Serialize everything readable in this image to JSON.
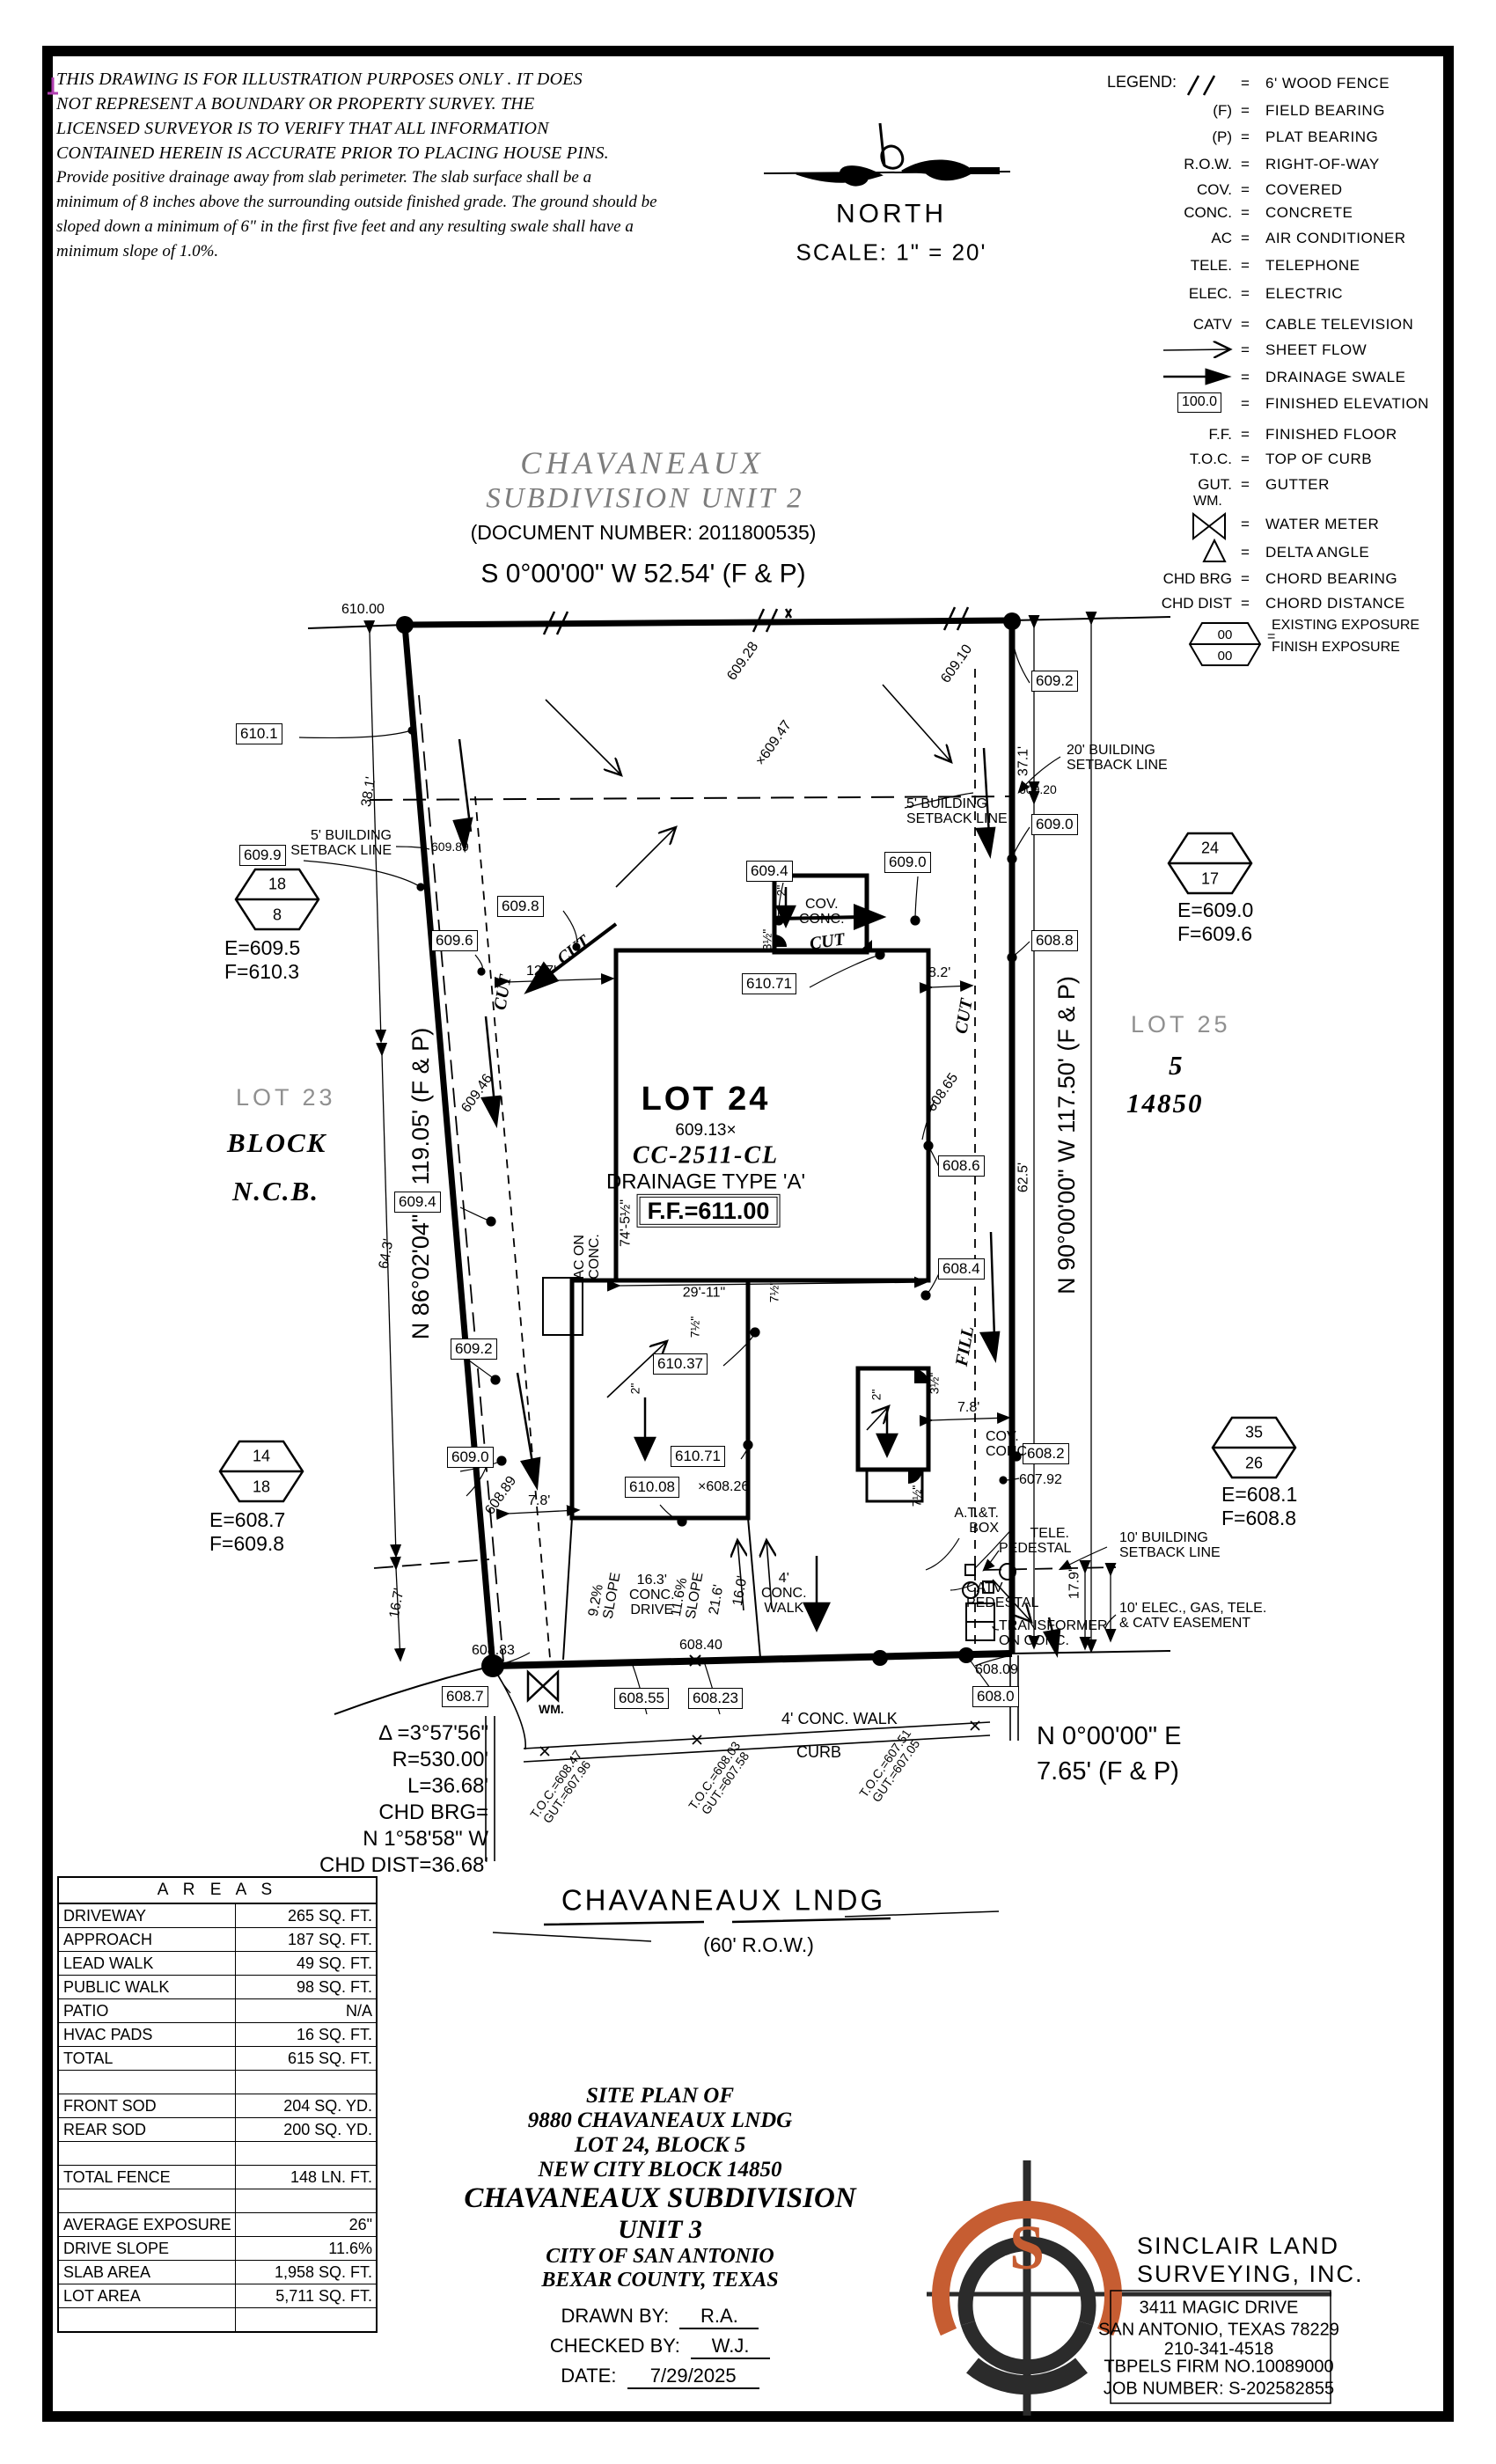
{
  "disclaimer": {
    "l1": "THIS DRAWING IS FOR ILLUSTRATION PURPOSES ONLY . IT DOES",
    "l2": "NOT REPRESENT A BOUNDARY OR PROPERTY SURVEY. THE",
    "l3": "LICENSED SURVEYOR IS TO VERIFY THAT ALL INFORMATION",
    "l4": "CONTAINED HEREIN IS ACCURATE PRIOR TO PLACING HOUSE PINS.",
    "l5": "Provide positive drainage away from slab perimeter. The slab surface shall be a",
    "l6": "minimum of 8 inches above the surrounding outside finished grade. The ground should be",
    "l7": "sloped down a minimum of 6\" in the first five feet and any resulting swale shall have a",
    "l8": "minimum slope of 1.0%."
  },
  "north": {
    "label": "NORTH",
    "scale": "SCALE:  1\" = 20'"
  },
  "legend": {
    "title": "LEGEND:",
    "fence_sym": "//",
    "fence": "6' WOOD FENCE",
    "f_sym": "(F)",
    "f": "FIELD BEARING",
    "p_sym": "(P)",
    "p": "PLAT BEARING",
    "row_sym": "R.O.W.",
    "row": "RIGHT-OF-WAY",
    "cov_sym": "COV.",
    "cov": "COVERED",
    "conc_sym": "CONC.",
    "conc": "CONCRETE",
    "ac_sym": "AC",
    "ac": "AIR CONDITIONER",
    "tele_sym": "TELE.",
    "tele": "TELEPHONE",
    "elec_sym": "ELEC.",
    "elec": "ELECTRIC",
    "catv_sym": "CATV",
    "catv": "CABLE TELEVISION",
    "sheetflow": "SHEET FLOW",
    "swale": "DRAINAGE SWALE",
    "fe_val": "100.0",
    "fe": "FINISHED ELEVATION",
    "ff_sym": "F.F.",
    "ff": "FINISHED FLOOR",
    "toc_sym": "T.O.C.",
    "toc": "TOP OF CURB",
    "gut_sym": "GUT.",
    "gut": "GUTTER",
    "wm_sym": "WM.",
    "wm": "WATER METER",
    "delta": "DELTA ANGLE",
    "chdbrg_sym": "CHD BRG",
    "chdbrg": "CHORD BEARING",
    "chddist_sym": "CHD DIST",
    "chddist": "CHORD DISTANCE",
    "hex_a": "00",
    "hex_b": "00",
    "hex1": "EXISTING EXPOSURE",
    "hex2": "FINISH EXPOSURE"
  },
  "plat": {
    "t1": "CHAVANEAUX",
    "t2": "SUBDIVISION  UNIT  2",
    "doc": "(DOCUMENT NUMBER: 2011800535)",
    "brg_top": "S 0°00'00\" W 52.54' (F & P)",
    "brg_left": "N 86°02'04\" E 119.05' (F & P)",
    "brg_right": "N 90°00'00\" W 117.50' (F & P)",
    "brg_bot1": "N 0°00'00\" E",
    "brg_bot2": "7.65' (F & P)",
    "street": "CHAVANEAUX LNDG",
    "rowlbl": "(60' R.O.W.)"
  },
  "curve": {
    "d": "Δ =3°57'56\"",
    "r": "R=530.00'",
    "l": "L=36.68'",
    "cb": "CHD BRG=",
    "cb2": "N 1°58'58\" W",
    "cd": "CHD DIST=36.68'"
  },
  "lots": {
    "lot23": "LOT 23",
    "block": "BLOCK",
    "ncb": "N.C.B.",
    "lot25": "LOT 25",
    "five": "5",
    "ncb25": "14850",
    "lot24": "LOT 24",
    "spot": "609.13×",
    "model": "CC-2511-CL",
    "drain": "DRAINAGE  TYPE  'A'",
    "ff": "F.F.=611.00"
  },
  "hex": {
    "h1a": "18",
    "h1b": "8",
    "h1e": "E=609.5",
    "h1f": "F=610.3",
    "h2a": "24",
    "h2b": "17",
    "h2e": "E=609.0",
    "h2f": "F=609.6",
    "h3a": "14",
    "h3b": "18",
    "h3e": "E=608.7",
    "h3f": "F=609.8",
    "h4a": "35",
    "h4b": "26",
    "h4e": "E=608.1",
    "h4f": "F=608.8"
  },
  "setback": {
    "s5a": "5' BUILDING",
    "s5b": "SETBACK LINE",
    "s20a": "20' BUILDING",
    "s20b": "SETBACK LINE",
    "s10a": "10' BUILDING",
    "s10b": "SETBACK LINE",
    "ease1": "10' ELEC., GAS, TELE.",
    "ease2": "& CATV EASEMENT"
  },
  "util": {
    "att1": "A.T.&T.",
    "att2": "BOX",
    "tele1": "TELE.",
    "tele2": "PEDESTAL",
    "catv1": "CATV",
    "catv2": "PEDESTAL",
    "tr1": "TRANSFORMER",
    "tr2": "ON CONC.",
    "wm": "WM.",
    "ac1": "AC ON",
    "ac2": "CONC.",
    "cov1": "COV.",
    "cov2": "CONC."
  },
  "elev": {
    "b610_1": "610.1",
    "b609_9": "609.9",
    "b609_8": "609.8",
    "b609_6": "609.6",
    "b609_4t": "609.4",
    "b609_0t": "609.0",
    "b609_2tr": "609.2",
    "b609_0r": "609.0",
    "b608_8r": "608.8",
    "b610_71a": "610.71",
    "b608_6": "608.6",
    "b608_4": "608.4",
    "b609_2l": "609.2",
    "b609_0l": "609.0",
    "b609_4l": "609.4",
    "b610_37": "610.37",
    "b610_71b": "610.71",
    "b610_08": "610.08",
    "b608_2": "608.2",
    "b608_7": "608.7",
    "b608_55": "608.55",
    "b608_23": "608.23",
    "b608_0": "608.0",
    "e610_00": "610.00",
    "e609_28": "609.28",
    "e609_47": "×609.47",
    "e609_10": "609.10",
    "e609_89": "609.89",
    "e609_20": "609.20",
    "e609_46": "609.46",
    "e608_89": "608.89",
    "e608_65": "608.65",
    "e608_26": "×608.26",
    "e607_92": "607.92",
    "e608_83": "608.83",
    "e608_40": "608.40",
    "e608_09": "608.09"
  },
  "toc": {
    "t": "T.O.C.=",
    "g": "GUT.=",
    "t1": "608.47",
    "g1": "607.96",
    "t2": "608.03",
    "g2": "607.58",
    "t3": "607.51",
    "g3": "607.05"
  },
  "dims": {
    "d38": "38.1'",
    "d64": "64.3'",
    "d16_7": "16.7'",
    "d12_7": "12.7'",
    "d8_2": "8.2'",
    "d37": "37.1'",
    "d62": "62.5'",
    "d7_8": "7.8'",
    "d17_9": "17.9'",
    "d74": "74'-5½\"",
    "d29": "29'-11\"",
    "d21": "21.6'",
    "d16_0": "16.0'",
    "d16_3": "16.3'",
    "dconc": "CONC.",
    "ddrive": "DRIVE",
    "s92": "9.2%",
    "s116": "11.6%",
    "slope": "SLOPE",
    "d2": "2\"",
    "d35": "3½\"",
    "d75": "7½\"",
    "w4a": "4'",
    "w4b": "CONC.",
    "w4c": "WALK",
    "walkst": "4' CONC. WALK",
    "curb": "CURB",
    "cut": "CUT",
    "fill": "FILL"
  },
  "areas": {
    "header": "A R E A S",
    "rows": [
      {
        "label": "DRIVEWAY",
        "value": "265 SQ. FT."
      },
      {
        "label": "APPROACH",
        "value": "187 SQ. FT."
      },
      {
        "label": "LEAD WALK",
        "value": "49 SQ. FT."
      },
      {
        "label": "PUBLIC WALK",
        "value": "98 SQ. FT."
      },
      {
        "label": "PATIO",
        "value": "N/A"
      },
      {
        "label": "HVAC PADS",
        "value": "16 SQ. FT."
      },
      {
        "label": "TOTAL",
        "value": "615 SQ. FT."
      },
      {
        "label": "",
        "value": ""
      },
      {
        "label": "FRONT SOD",
        "value": "204 SQ. YD."
      },
      {
        "label": "REAR SOD",
        "value": "200 SQ. YD."
      },
      {
        "label": "",
        "value": ""
      },
      {
        "label": "TOTAL FENCE",
        "value": "148  LN. FT."
      },
      {
        "label": "",
        "value": ""
      },
      {
        "label": "AVERAGE EXPOSURE",
        "value": "26\""
      },
      {
        "label": "DRIVE SLOPE",
        "value": "11.6%"
      },
      {
        "label": "SLAB AREA",
        "value": "1,958 SQ. FT."
      },
      {
        "label": "LOT AREA",
        "value": "5,711 SQ. FT."
      },
      {
        "label": "",
        "value": ""
      }
    ]
  },
  "titleblock": {
    "l1": "SITE  PLAN  OF",
    "l2": "9880  CHAVANEAUX  LNDG",
    "l3": "LOT  24,  BLOCK  5",
    "l4": "NEW  CITY  BLOCK  14850",
    "l5": "CHAVANEAUX  SUBDIVISION",
    "l6": "UNIT  3",
    "l7": "CITY  OF  SAN  ANTONIO",
    "l8": "BEXAR  COUNTY,  TEXAS",
    "drawn": "DRAWN  BY:",
    "drawnv": "R.A.",
    "checked": "CHECKED  BY:",
    "checkedv": "W.J.",
    "date": "DATE:",
    "datev": "7/29/2025"
  },
  "firm": {
    "n1": "SINCLAIR  LAND",
    "n2": "SURVEYING,  INC.",
    "a1": "3411  MAGIC  DRIVE",
    "a2": "SAN  ANTONIO,  TEXAS  78229",
    "a3": "210-341-4518",
    "a4": "TBPELS  FIRM  NO.10089000",
    "a5": "JOB  NUMBER:  S-202582855",
    "logo_s": "S",
    "orange": "#c65d32"
  }
}
